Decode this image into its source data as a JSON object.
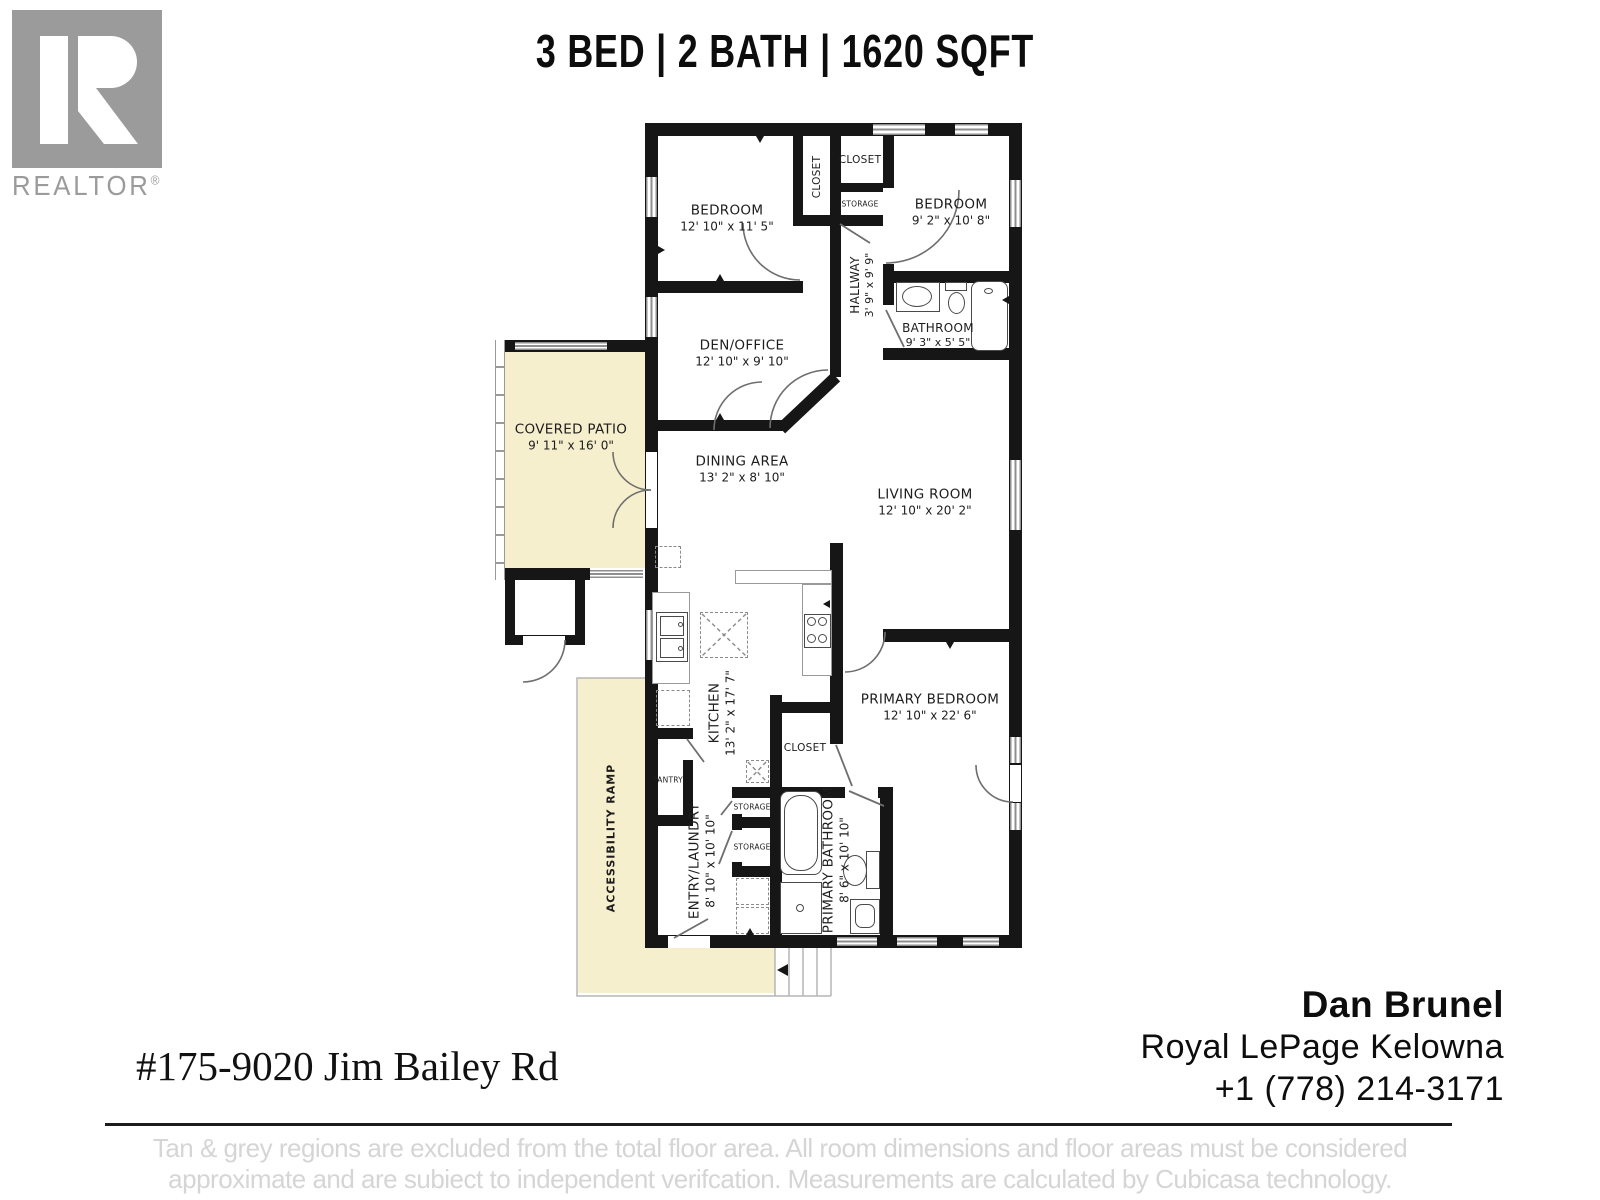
{
  "header": {
    "title": "3 BED | 2 BATH | 1620 SQFT"
  },
  "logo": {
    "letter": "R",
    "label": "REALTOR",
    "registered": "®"
  },
  "rooms": {
    "bedroom1": {
      "name": "BEDROOM",
      "dims": "12' 10\" x 11' 5\""
    },
    "closet_strip": {
      "name": "CLOSET"
    },
    "closet_top": {
      "name": "CLOSET"
    },
    "storage_top": {
      "name": "STORAGE"
    },
    "bedroom2": {
      "name": "BEDROOM",
      "dims": "9' 2\" x 10' 8\""
    },
    "hallway": {
      "name": "HALLWAY",
      "dims": "3' 9\" x 9' 9\""
    },
    "bathroom": {
      "name": "BATHROOM",
      "dims": "9' 3\" x 5' 5\""
    },
    "den_office": {
      "name": "DEN/OFFICE",
      "dims": "12' 10\" x 9' 10\""
    },
    "covered_patio": {
      "name": "COVERED PATIO",
      "dims": "9' 11\" x 16' 0\""
    },
    "dining_area": {
      "name": "DINING AREA",
      "dims": "13' 2\" x 8' 10\""
    },
    "living_room": {
      "name": "LIVING ROOM",
      "dims": "12' 10\" x 20' 2\""
    },
    "kitchen": {
      "name": "KITCHEN",
      "dims": "13' 2\" x 17' 7\""
    },
    "pantry": {
      "name": "PANTRY"
    },
    "closet_mid": {
      "name": "CLOSET"
    },
    "primary_bedroom": {
      "name": "PRIMARY BEDROOM",
      "dims": "12' 10\" x 22' 6\""
    },
    "entry_laundry": {
      "name": "ENTRY/LAUNDRY",
      "dims": "8' 10\" x 10' 10\""
    },
    "storage1": {
      "name": "STORAGE"
    },
    "storage2": {
      "name": "STORAGE"
    },
    "primary_bathroom": {
      "name": "PRIMARY BATHROOM",
      "dims": "8' 6\" x 10' 10\""
    },
    "accessibility_ramp": {
      "name": "ACCESSIBILITY RAMP"
    }
  },
  "footer": {
    "address": "#175-9020 Jim Bailey Rd",
    "agent_name": "Dan Brunel",
    "agent_company": "Royal LePage Kelowna",
    "agent_phone": "+1 (778) 214-3171",
    "disclaimer_line1": "Tan & grey regions are excluded from the total floor area. All room dimensions and floor areas must be considered",
    "disclaimer_line2": "approximate and are subiect to independent verifcation. Measurements are calculated by Cubicasa technology."
  },
  "colors": {
    "wall": "#161616",
    "excluded_region_tan": "#f5efcd",
    "logo_gray": "#9b9b9b",
    "disclaimer_gray": "#d5d5d5",
    "fixture_line": "#6e6e6e"
  }
}
